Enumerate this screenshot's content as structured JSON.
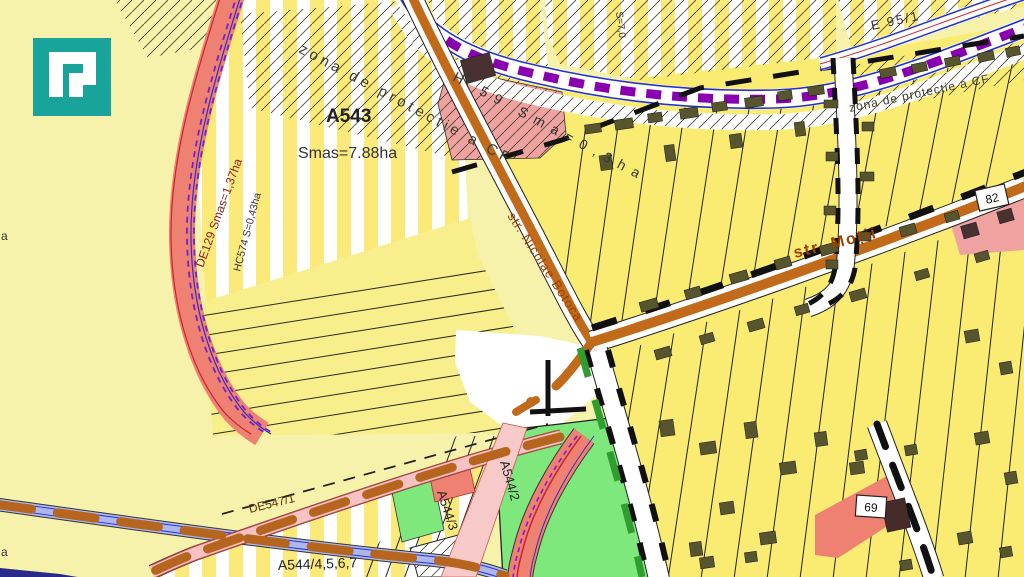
{
  "map": {
    "type": "cadastral-zoning-map",
    "labels": {
      "zona_cf_left": "zona de protectie a CF",
      "zona_cf_right": "zona de protectie a CF",
      "a543": "A543",
      "smas": "Smas=7.88ha",
      "de129": "DE129 Smas=1,37ha",
      "hc574": "HC574 S=0,43ha",
      "h59": "H 59 Sma=0,3ha",
      "s70": "S=7,0",
      "e95": "E 95/1",
      "str_botoca": "str. Nicolae Botoca",
      "str_motii": "str. Moții",
      "box82": "82",
      "box69": "69",
      "a544_2": "A544/2",
      "a544_3": "A544/3",
      "de547": "DE547/1",
      "a544_4567": "A544/4,5,6,7",
      "edge_a_left": "a",
      "edge_a_bottom": "a"
    }
  },
  "palette": {
    "base": "#f6f2ab",
    "stripe_yellow": "#fbe97a",
    "parcel_yellow": "#faec72",
    "field_yellow": "#f8ef8c",
    "salmon_road": "#ee8172",
    "pink_road": "#f5c3c3",
    "pink_zone": "#efa2a0",
    "orange_road": "#c06a1a",
    "brown_dash": "#b5651d",
    "railway_purple": "#8800b0",
    "line_blue": "#2233cc",
    "canal_lavender": "#aeb6ec",
    "green_area": "#7fe87d",
    "green_dash": "#2f9e2f",
    "building_olive": "#56552e",
    "building_dark": "#4a3131",
    "logo_teal": "#18a39b",
    "street_label": "#9c3f00",
    "road_label_red": "#8b1a1a"
  }
}
